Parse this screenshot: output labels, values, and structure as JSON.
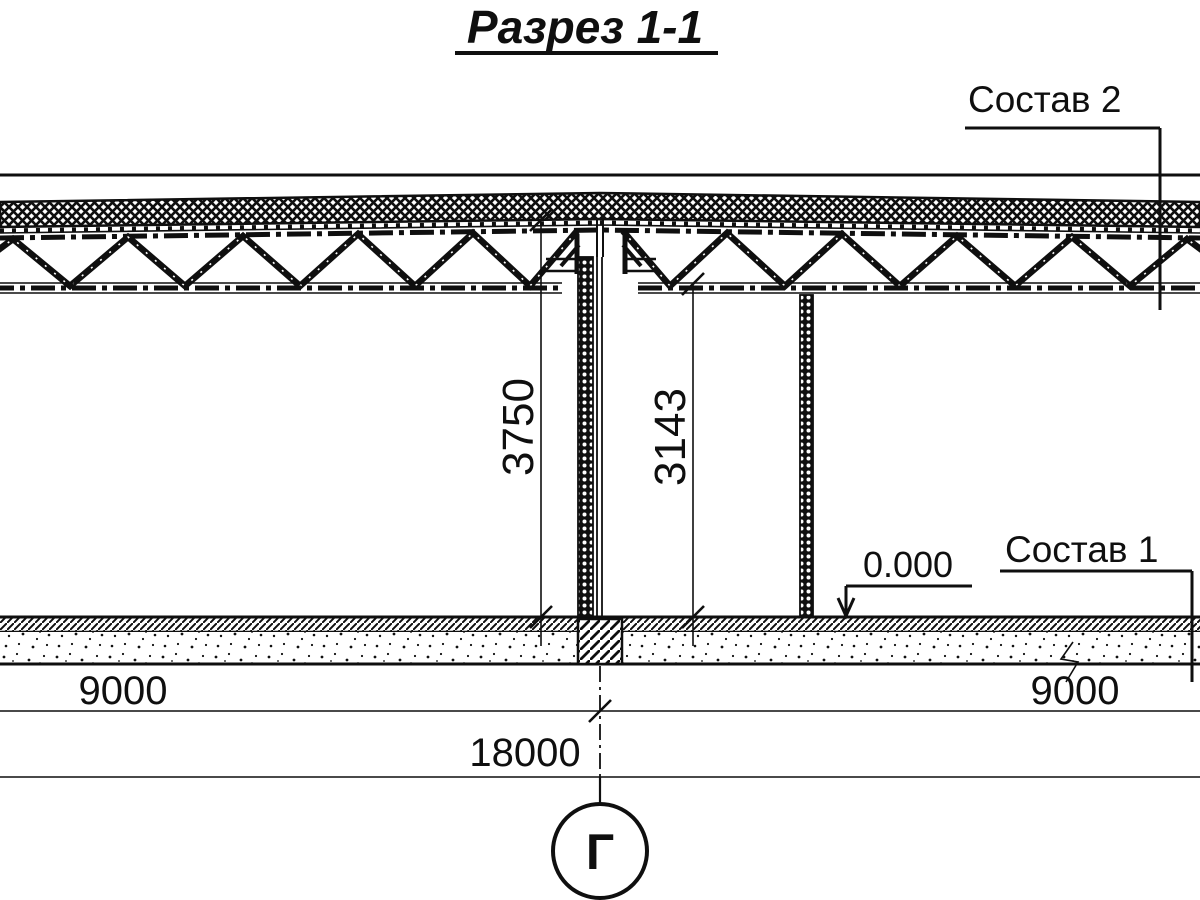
{
  "title": "Разрез 1-1",
  "callouts": {
    "roof_composition": "Состав 2",
    "floor_composition": "Состав 1",
    "floor_elevation": "0.000"
  },
  "dimensions": {
    "roof_top_height": "3750",
    "truss_bottom_height": "3143",
    "bay_left": "9000",
    "bay_right": "9000",
    "total_span": "18000"
  },
  "axis": {
    "label": "Г"
  },
  "colors": {
    "ink": "#0f0f0f",
    "background": "#ffffff"
  }
}
